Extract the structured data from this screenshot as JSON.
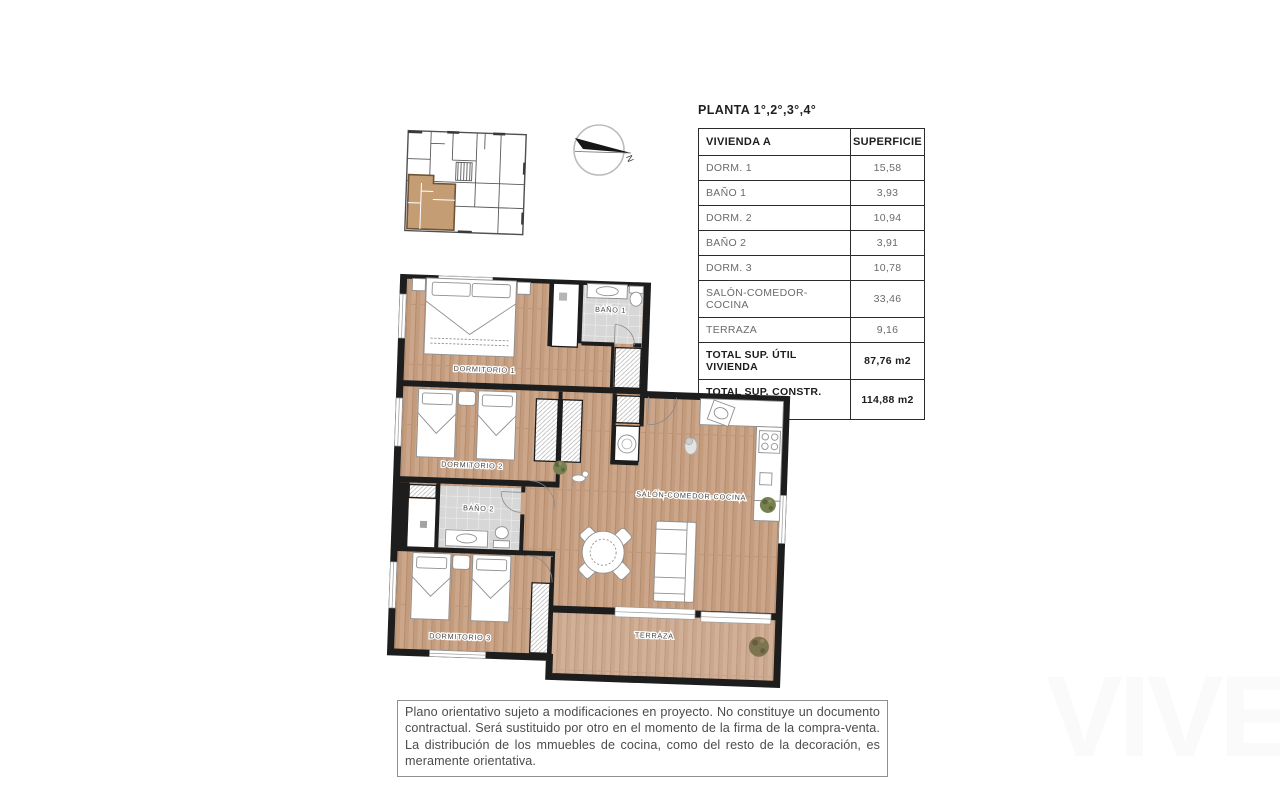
{
  "document": {
    "planta_heading": "PLANTA 1°,2°,3°,4°"
  },
  "surface_table": {
    "header": {
      "unit": "VIVIENDA A",
      "surface": "SUPERFICIE"
    },
    "rows": [
      {
        "label": "DORM. 1",
        "value": "15,58"
      },
      {
        "label": "BAÑO 1",
        "value": "3,93"
      },
      {
        "label": "DORM. 2",
        "value": "10,94"
      },
      {
        "label": "BAÑO 2",
        "value": "3,91"
      },
      {
        "label": "DORM. 3",
        "value": "10,78"
      },
      {
        "label": "SALÓN-COMEDOR-COCINA",
        "value": "33,46"
      },
      {
        "label": "TERRAZA",
        "value": "9,16"
      }
    ],
    "totals": [
      {
        "label": "TOTAL SUP. ÚTIL VIVIENDA",
        "value": "87,76 m2"
      },
      {
        "label_line1": "TOTAL SUP. CONSTR.",
        "label_line2": "VIV + PP +ZC",
        "value": "114,88 m2"
      }
    ]
  },
  "plan": {
    "rooms": {
      "dorm1": "DORMITORIO 1",
      "bano1": "BAÑO 1",
      "dorm2": "DORMITORIO 2",
      "bano2": "BAÑO 2",
      "dorm3": "DORMITORIO 3",
      "salon": "SALÓN-COMEDOR-COCINA",
      "terraza": "TERRAZA"
    }
  },
  "compass": {
    "north_label": "N"
  },
  "disclaimer": {
    "text": "Plano orientativo sujeto a modificaciones en proyecto. No constituye un documento contractual. Será sustituido por otro en el momento de la firma de la compra-venta. La distribución de los mmuebles de cocina, como del resto de la decoración, es meramente orientativa."
  },
  "watermark": {
    "text": "VIVE"
  },
  "colors": {
    "wall": "#1d1d1d",
    "wood_floor": "#c9a184",
    "tile_floor": "#d7d7d7",
    "key_plan_highlight": "#c59d75",
    "plant_green": "#76814f"
  }
}
